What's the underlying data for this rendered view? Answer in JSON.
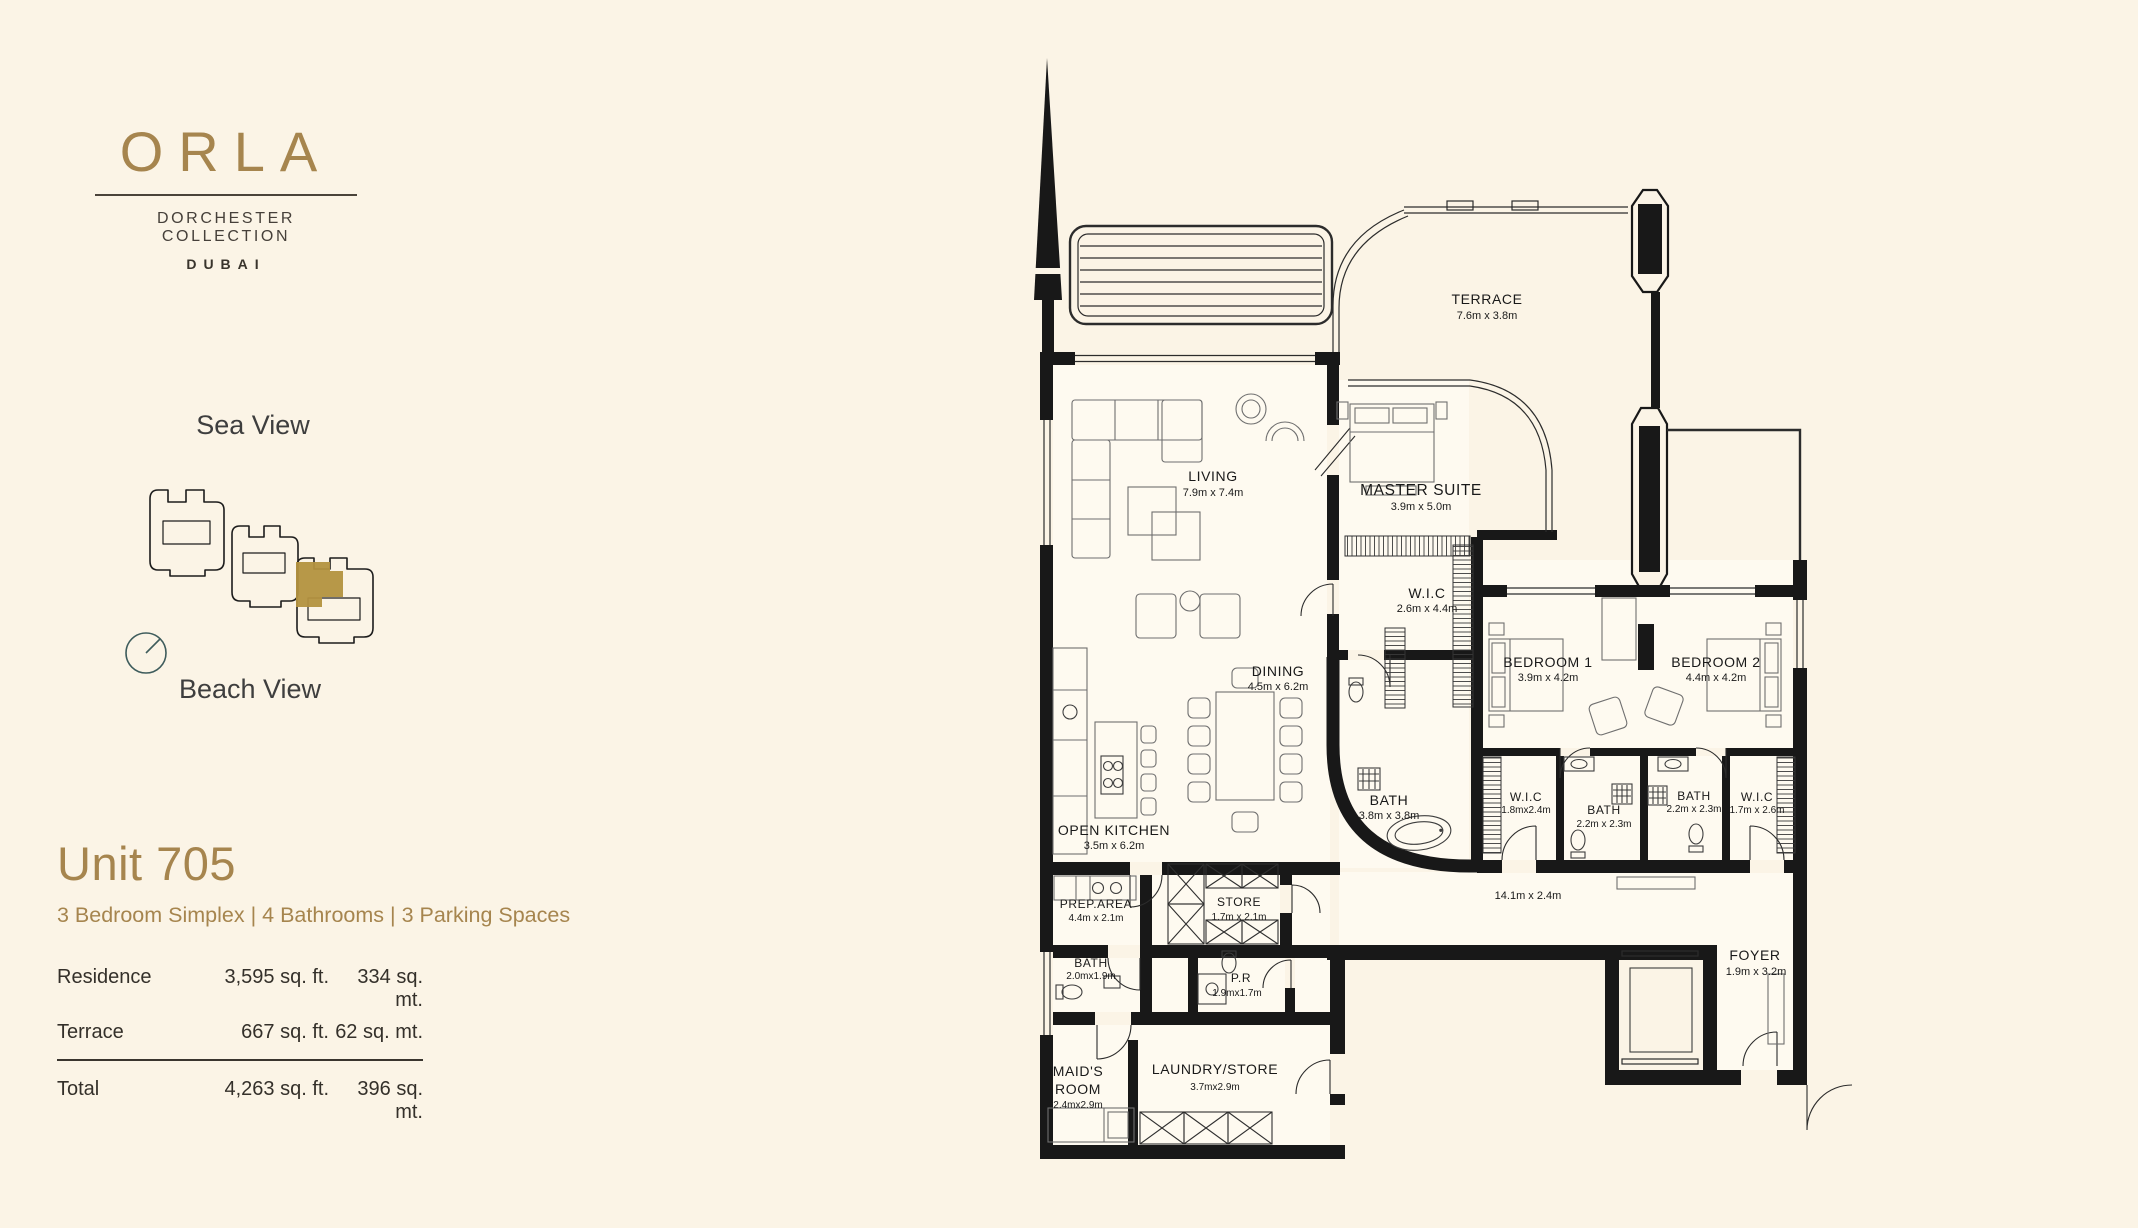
{
  "brand": {
    "logo": "ORLA",
    "collection": "DORCHESTER COLLECTION",
    "city": "DUBAI"
  },
  "views": {
    "sea": "Sea View",
    "beach": "Beach View"
  },
  "unit": {
    "title": "Unit 705",
    "subtitle": "3 Bedroom Simplex | 4 Bathrooms | 3 Parking Spaces",
    "areas": [
      {
        "label": "Residence",
        "sqft": "3,595 sq. ft.",
        "sqmt": "334 sq. mt."
      },
      {
        "label": "Terrace",
        "sqft": "667 sq. ft.",
        "sqmt": "62 sq. mt."
      }
    ],
    "total": {
      "label": "Total",
      "sqft": "4,263 sq. ft.",
      "sqmt": "396 sq. mt."
    }
  },
  "plan": {
    "rooms": [
      {
        "name": "TERRACE",
        "dims": "7.6m x 3.8m"
      },
      {
        "name": "LIVING",
        "dims": "7.9m x 7.4m"
      },
      {
        "name": "MASTER SUITE",
        "dims": "3.9m x 5.0m"
      },
      {
        "name": "W.I.C",
        "dims": "2.6m x 4.4m"
      },
      {
        "name": "DINING",
        "dims": "4.5m x 6.2m"
      },
      {
        "name": "OPEN KITCHEN",
        "dims": "3.5m x 6.2m"
      },
      {
        "name": "BATH",
        "dims": "3.8m x 3.8m"
      },
      {
        "name": "BEDROOM 1",
        "dims": "3.9m x 4.2m"
      },
      {
        "name": "BEDROOM 2",
        "dims": "4.4m x 4.2m"
      },
      {
        "name": "W.I.C",
        "dims": "1.8mx2.4m"
      },
      {
        "name": "BATH",
        "dims": "2.2m x 2.3m"
      },
      {
        "name": "BATH",
        "dims": "2.2m x 2.3m"
      },
      {
        "name": "W.I.C",
        "dims": "1.7m x 2.6m"
      },
      {
        "name": "",
        "dims": "14.1m x 2.4m"
      },
      {
        "name": "PREP.AREA",
        "dims": "4.4m x 2.1m"
      },
      {
        "name": "STORE",
        "dims": "1.7m x 2.1m"
      },
      {
        "name": "BATH",
        "dims": "2.0mx1.9m"
      },
      {
        "name": "P.R",
        "dims": "1.9mx1.7m"
      },
      {
        "name": "MAID'S",
        "name2": "ROOM",
        "dims": "2.4mx2.9m"
      },
      {
        "name": "LAUNDRY/STORE",
        "dims": "3.7mx2.9m"
      },
      {
        "name": "FOYER",
        "dims": "1.9m x 3.2m"
      }
    ]
  },
  "colors": {
    "background": "#fbf4e6",
    "gold": "#a6854e",
    "ink": "#34302a",
    "wall": "#181818",
    "compass": "#3e5c5c",
    "site_highlight": "#b3923f"
  }
}
